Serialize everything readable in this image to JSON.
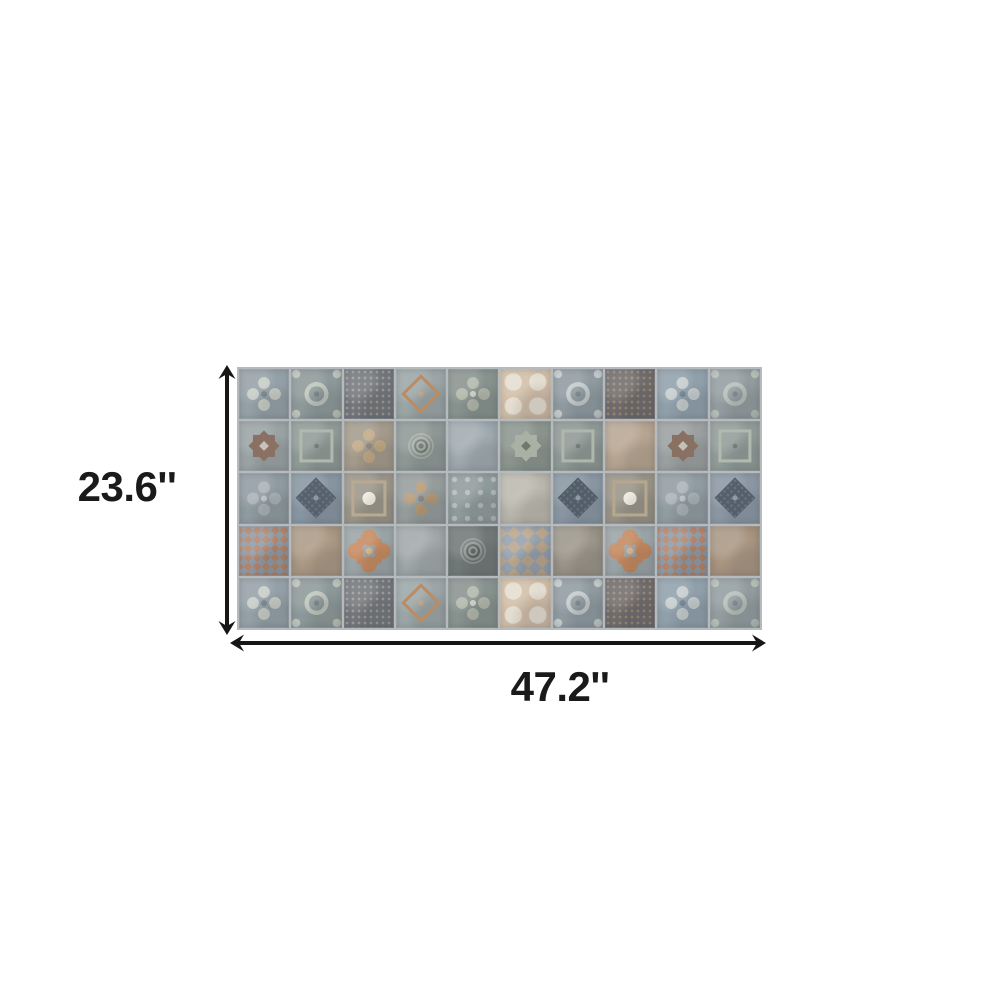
{
  "figure": {
    "height_label": "23.6''",
    "width_label": "47.2''",
    "arrow_color": "#161616",
    "label_color": "#1a1a1a",
    "background_color": "#ffffff"
  },
  "panel": {
    "description": "patchwork decorative tile panel, 10 columns x 5 rows",
    "grout_color": "#b4babd",
    "rows": 5,
    "cols": 10,
    "tiles": [
      {
        "p": "quatrefoil",
        "b": "#94a0a7",
        "a": "#c7cbc5",
        "c": "#76828a"
      },
      {
        "p": "wreath",
        "b": "#8c9899",
        "a": "#bdc3bb",
        "c": "#757f80"
      },
      {
        "p": "lattice",
        "b": "#72767c",
        "a": "#a09a8e"
      },
      {
        "p": "diamond-outline",
        "b": "#9ba5a5",
        "a": "#bb8b64",
        "c": "#c7a37b"
      },
      {
        "p": "quatrefoil",
        "b": "#87928e",
        "a": "#b0b7a9",
        "c": "#cdd2c6"
      },
      {
        "p": "rosettes",
        "b": "#d0bda7",
        "a": "#e3dcd0",
        "c": "#bd8a60"
      },
      {
        "p": "wreath",
        "b": "#8e9aa0",
        "a": "#c3c9c9",
        "c": "#76828a"
      },
      {
        "p": "lattice",
        "b": "#6e6b6d",
        "a": "#9a8771"
      },
      {
        "p": "quatrefoil",
        "b": "#90a0ab",
        "a": "#c5ccce",
        "c": "#72828e"
      },
      {
        "p": "wreath",
        "b": "#929c9e",
        "a": "#b6beb8",
        "c": "#7a8486"
      },
      {
        "p": "star",
        "b": "#9aa2a4",
        "a": "#8a7164",
        "c": "#c6c2b8"
      },
      {
        "p": "frame",
        "b": "#8f9a96",
        "a": "#b1b9af",
        "c": "#6d7873"
      },
      {
        "p": "quatrefoil",
        "b": "#a39a8b",
        "a": "#c0a885",
        "c": "#8c8477"
      },
      {
        "p": "medallion",
        "b": "#8d9895",
        "a": "#a8afa7",
        "c": "#717c77"
      },
      {
        "p": "wash",
        "b": "#9aa5ab",
        "a": "#adb6bb"
      },
      {
        "p": "star",
        "b": "#8a948d",
        "a": "#a9b1a5",
        "c": "#6e786f"
      },
      {
        "p": "frame",
        "b": "#8e9894",
        "a": "#afb7ad",
        "c": "#6c7772"
      },
      {
        "p": "wash",
        "b": "#b1a08d",
        "a": "#c3b19b"
      },
      {
        "p": "star",
        "b": "#9a9fa0",
        "a": "#887062",
        "c": "#c4c0b6"
      },
      {
        "p": "frame",
        "b": "#909b97",
        "a": "#b2bab0",
        "c": "#6e7974"
      },
      {
        "p": "quatrefoil",
        "b": "#8f9aa1",
        "a": "#a9b1b6",
        "c": "#bdc4c7"
      },
      {
        "p": "diamond",
        "b": "#8795a1",
        "a": "#56616d",
        "c": "#8e98a2"
      },
      {
        "p": "frame-rosette",
        "b": "#9a9589",
        "a": "#b8a990",
        "c": "#f0ece2"
      },
      {
        "p": "quatrefoil",
        "b": "#949c9b",
        "a": "#b49976",
        "c": "#87807a"
      },
      {
        "p": "dotgrid",
        "b": "#8f9a9b",
        "a": "#b5bcb7"
      },
      {
        "p": "wash",
        "b": "#b4b2a8",
        "a": "#c8c5b9"
      },
      {
        "p": "diamond",
        "b": "#8896a2",
        "a": "#525d69",
        "c": "#8f99a3"
      },
      {
        "p": "frame-rosette",
        "b": "#989387",
        "a": "#b6a78e",
        "c": "#efebe1"
      },
      {
        "p": "quatrefoil",
        "b": "#909ba2",
        "a": "#aab2b7",
        "c": "#bec5c8"
      },
      {
        "p": "diamond",
        "b": "#8a97a3",
        "a": "#555f6b",
        "c": "#919ba5"
      },
      {
        "p": "checker",
        "b": "#8e9aa6",
        "a": "#b97f5e",
        "s": 9
      },
      {
        "p": "wash",
        "b": "#a4937f",
        "a": "#b8a78f"
      },
      {
        "p": "floral",
        "b": "#9aa3a6",
        "a": "#c58a60",
        "c": "#dab284"
      },
      {
        "p": "wash",
        "b": "#9aa2a3",
        "a": "#aeb5b5"
      },
      {
        "p": "medallion",
        "b": "#707877",
        "a": "#8f9692",
        "c": "#585f5d"
      },
      {
        "p": "checker",
        "b": "#95a0ab",
        "a": "#bfa586",
        "s": 14
      },
      {
        "p": "wash",
        "b": "#948e83",
        "a": "#a9a397"
      },
      {
        "p": "floral",
        "b": "#99a2a5",
        "a": "#c2875e",
        "c": "#d9b183"
      },
      {
        "p": "checker",
        "b": "#8e9aa6",
        "a": "#b97f5e",
        "s": 9
      },
      {
        "p": "wash",
        "b": "#a28f7c",
        "a": "#b7a58f"
      },
      {
        "p": "quatrefoil",
        "b": "#94a0a7",
        "a": "#c7cbc5",
        "c": "#76828a"
      },
      {
        "p": "wreath",
        "b": "#8c9899",
        "a": "#bdc3bb",
        "c": "#757f80"
      },
      {
        "p": "lattice",
        "b": "#72767c",
        "a": "#a09a8e"
      },
      {
        "p": "diamond-outline",
        "b": "#9ba5a5",
        "a": "#bb8b64",
        "c": "#c7a37b"
      },
      {
        "p": "quatrefoil",
        "b": "#87928e",
        "a": "#b0b7a9",
        "c": "#cdd2c6"
      },
      {
        "p": "rosettes",
        "b": "#d0bda7",
        "a": "#e3dcd0",
        "c": "#bd8a60"
      },
      {
        "p": "wreath",
        "b": "#8e9aa0",
        "a": "#c3c9c9",
        "c": "#76828a"
      },
      {
        "p": "lattice",
        "b": "#6e6b6d",
        "a": "#9a8771"
      },
      {
        "p": "quatrefoil",
        "b": "#90a0ab",
        "a": "#c5ccce",
        "c": "#72828e"
      },
      {
        "p": "wreath",
        "b": "#929c9e",
        "a": "#b6beb8",
        "c": "#7a8486"
      }
    ]
  }
}
